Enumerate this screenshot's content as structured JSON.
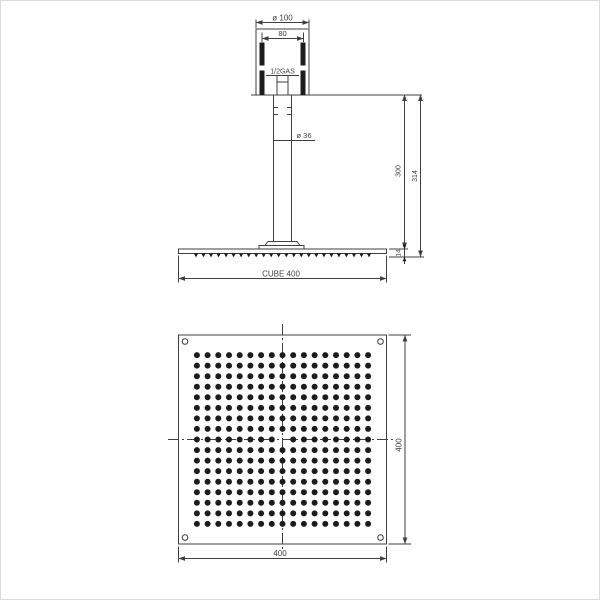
{
  "page": {
    "background": "#ffffff",
    "line_color": "#3f3f3f",
    "fill_color": "#1c1c1c",
    "border_color": "#dcdcdc"
  },
  "side_view": {
    "view_name": "side-elevation",
    "labels": {
      "top_diameter": "ø 100",
      "bolt_spacing": "80",
      "thread_size": "1/2GAS",
      "pipe_diameter": "ø 36",
      "drop_height": "300",
      "overall_height": "314",
      "head_thickness": "14",
      "product_name": "CUBE 400"
    },
    "nozzle_teeth_count": 24
  },
  "plan_view": {
    "view_name": "bottom-plan",
    "labels": {
      "width": "400",
      "depth": "400"
    },
    "nozzle_grid": {
      "rows": 17,
      "cols": 17,
      "center_dot_omitted": true
    },
    "corner_screw_count": 4
  }
}
